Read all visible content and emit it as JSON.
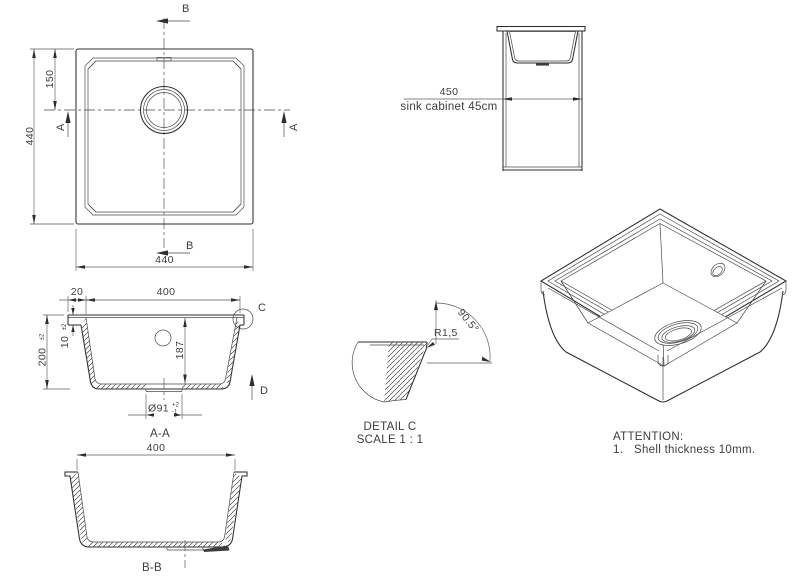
{
  "drawing": {
    "title": "Undermount sink technical drawing",
    "colors": {
      "line": "#3a3a3a",
      "background": "#ffffff"
    },
    "top_view": {
      "dim_height": "440",
      "dim_drain_offset": "150",
      "dim_width": "440",
      "section_a_left": "A",
      "section_a_right": "A",
      "section_b_top": "B",
      "section_b_bottom": "B"
    },
    "cabinet_view": {
      "dim": "450",
      "caption": "sink cabinet 45cm"
    },
    "section_aa": {
      "label": "A-A",
      "dim_flange": "20",
      "dim_inner_width": "400",
      "dim_rim": "10",
      "dim_rim_tol": "±2",
      "dim_height": "200",
      "dim_height_tol": "±2",
      "dim_depth": "187",
      "dim_drain": "Ø91",
      "dim_drain_tol_plus": "+2",
      "dim_drain_tol_minus": "-1",
      "detail_ref": "C",
      "arrow_d": "D"
    },
    "section_bb": {
      "label": "B-B",
      "dim_inner_width": "400"
    },
    "detail_c": {
      "radius": "R1,5",
      "angle": "90.5°",
      "title": "DETAIL C",
      "scale": "SCALE 1 : 1"
    },
    "notes": {
      "heading": "ATTENTION:",
      "item_number": "1.",
      "item_text": "Shell thickness 10mm."
    }
  }
}
